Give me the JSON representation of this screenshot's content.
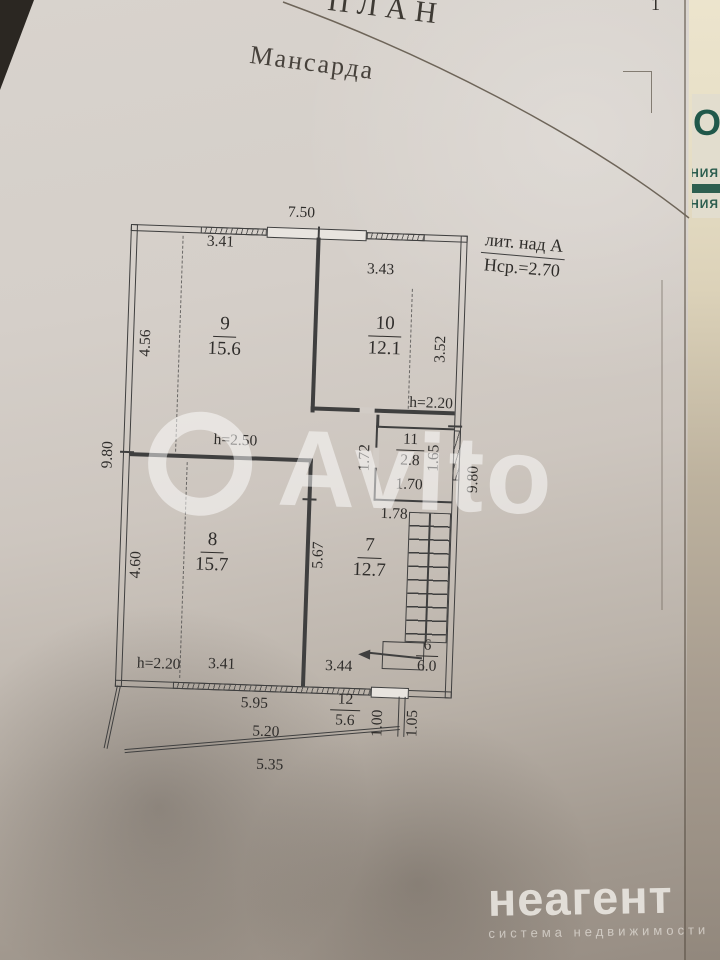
{
  "photo": {
    "page_title_partial": "ПЛАН",
    "floor_title": "Мансарда",
    "corner_mark": "1"
  },
  "plan": {
    "lit_label": "лит. над А",
    "avg_height": "Нср.=2.70",
    "rooms": {
      "r9": {
        "num": "9",
        "area": "15.6"
      },
      "r10": {
        "num": "10",
        "area": "12.1"
      },
      "r11": {
        "num": "11",
        "area": "2.8"
      },
      "r8": {
        "num": "8",
        "area": "15.7"
      },
      "r7": {
        "num": "7",
        "area": "12.7"
      },
      "r6": {
        "num": "6",
        "area": "6.0"
      },
      "r12": {
        "num": "12",
        "area": "5.6"
      }
    },
    "dims": {
      "top_total": "7.50",
      "top_left": "3.41",
      "top_right": "3.43",
      "room9_height": "4.56",
      "room10_height": "3.52",
      "left_total": "9.80",
      "right_total": "9.80",
      "h_top": "h=2.20",
      "h_mid": "h=2.50",
      "h_bottom": "h=2.20",
      "r11_left": "1.72",
      "r11_right": "1.65",
      "r11_width": "1.70",
      "r11_below": "1.78",
      "room8_height": "4.60",
      "stair_wall": "5.67",
      "bottom_left": "3.41",
      "bottom_mid": "3.44",
      "bottom_window": "5.95",
      "balcony_inner": "5.20",
      "balcony_outer": "5.35",
      "balcony_depth_inner": "1.00",
      "balcony_depth_outer": "1.05"
    }
  },
  "watermark": {
    "brand": "Avito"
  },
  "side_document": {
    "big_fragment": "ООО",
    "line1_fragment": "НИЯ",
    "line2_fragment": "ЕНИЯ"
  },
  "footer_logo": {
    "brand": "неагент",
    "tagline": "система недвижимости"
  },
  "colors": {
    "paper": "#d5cfc9",
    "table": "#2b2722",
    "accent_green": "#2e5f4f",
    "plan_line": "#3f3f3f"
  }
}
